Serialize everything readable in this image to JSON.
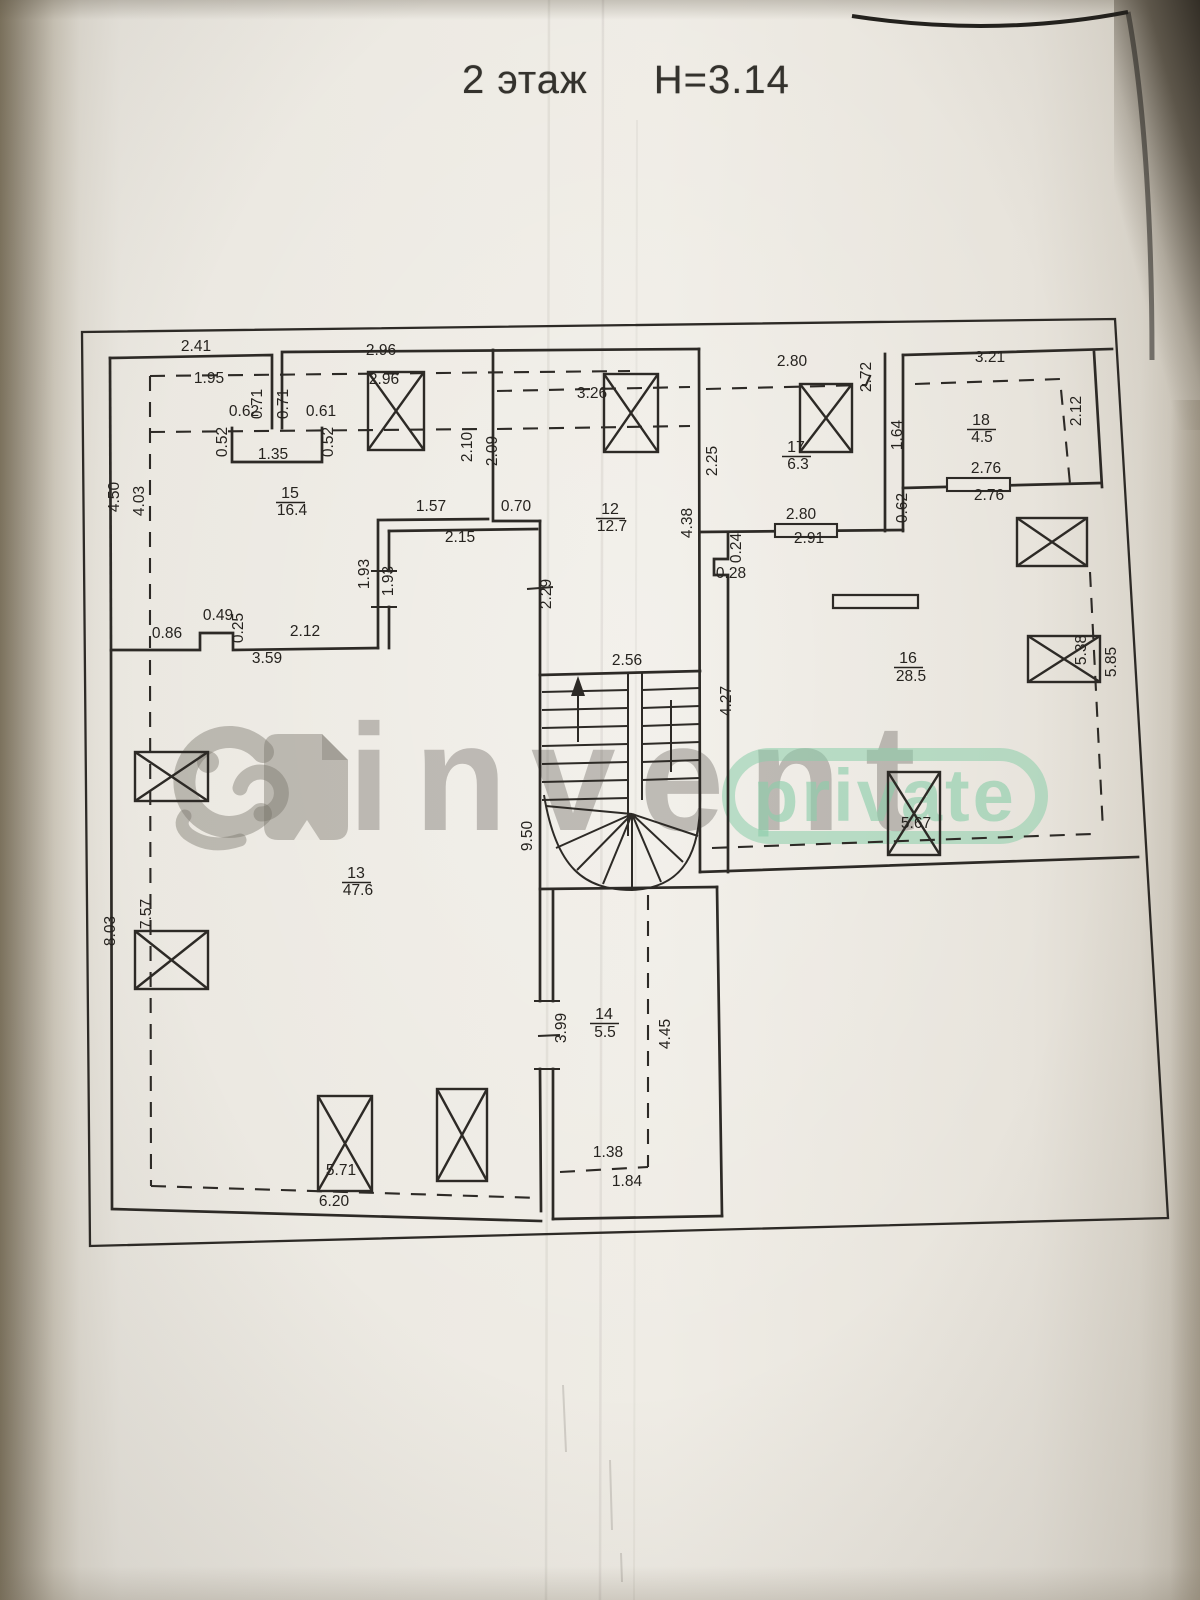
{
  "title": {
    "floor": "2 этаж",
    "height": "Н=3.14"
  },
  "watermark": {
    "brand": "invent",
    "badge": "private",
    "logo": "elephant-logo",
    "brand_color": "#69655e",
    "badge_color": "#8bcdaa"
  },
  "plan": {
    "rooms": [
      {
        "number": "12",
        "area_m2": "12.7"
      },
      {
        "number": "13",
        "area_m2": "47.6"
      },
      {
        "number": "14",
        "area_m2": "5.5"
      },
      {
        "number": "15",
        "area_m2": "16.4"
      },
      {
        "number": "16",
        "area_m2": "28.5"
      },
      {
        "number": "17",
        "area_m2": "6.3"
      },
      {
        "number": "18",
        "area_m2": "4.5"
      }
    ],
    "labels": [
      {
        "t": "2.41",
        "x": 196,
        "y": 351
      },
      {
        "t": "1.95",
        "x": 209,
        "y": 383
      },
      {
        "t": "0.71",
        "x": 262,
        "y": 404,
        "r": -90
      },
      {
        "t": "0.71",
        "x": 288,
        "y": 404,
        "r": -90
      },
      {
        "t": "0.62",
        "x": 244,
        "y": 416
      },
      {
        "t": "0.61",
        "x": 321,
        "y": 416
      },
      {
        "t": "0.52",
        "x": 227,
        "y": 442,
        "r": -90
      },
      {
        "t": "0.52",
        "x": 333,
        "y": 442,
        "r": -90
      },
      {
        "t": "1.35",
        "x": 273,
        "y": 459
      },
      {
        "t": "2.96",
        "x": 381,
        "y": 355
      },
      {
        "t": "2.96",
        "x": 384,
        "y": 384
      },
      {
        "t": "4.50",
        "x": 119,
        "y": 497,
        "r": -90
      },
      {
        "t": "4.03",
        "x": 144,
        "y": 501,
        "r": -90
      },
      {
        "t": "15",
        "x": 290,
        "y": 498,
        "k": "room",
        "u": 1
      },
      {
        "t": "16.4",
        "x": 292,
        "y": 515,
        "k": "area"
      },
      {
        "t": "1.57",
        "x": 431,
        "y": 511
      },
      {
        "t": "0.70",
        "x": 516,
        "y": 511
      },
      {
        "t": "2.15",
        "x": 460,
        "y": 542
      },
      {
        "t": "1.93",
        "x": 369,
        "y": 574,
        "r": -90
      },
      {
        "t": "1.93",
        "x": 393,
        "y": 581,
        "r": -90
      },
      {
        "t": "0.49",
        "x": 218,
        "y": 620
      },
      {
        "t": "0.25",
        "x": 243,
        "y": 628,
        "r": -90
      },
      {
        "t": "0.86",
        "x": 167,
        "y": 638
      },
      {
        "t": "2.12",
        "x": 305,
        "y": 636
      },
      {
        "t": "3.59",
        "x": 267,
        "y": 663
      },
      {
        "t": "3.26",
        "x": 592,
        "y": 398
      },
      {
        "t": "2.10",
        "x": 472,
        "y": 447,
        "r": -90
      },
      {
        "t": "2.09",
        "x": 497,
        "y": 451,
        "r": -90
      },
      {
        "t": "12",
        "x": 610,
        "y": 514,
        "k": "room",
        "u": 1
      },
      {
        "t": "12.7",
        "x": 612,
        "y": 531,
        "k": "area"
      },
      {
        "t": "2.29",
        "x": 551,
        "y": 594,
        "r": -90
      },
      {
        "t": "4.38",
        "x": 692,
        "y": 523,
        "r": -90
      },
      {
        "t": "2.56",
        "x": 627,
        "y": 665
      },
      {
        "t": "4.27",
        "x": 731,
        "y": 701,
        "r": -90
      },
      {
        "t": "9.50",
        "x": 532,
        "y": 836,
        "r": -90
      },
      {
        "t": "2.80",
        "x": 792,
        "y": 366
      },
      {
        "t": "2.72",
        "x": 871,
        "y": 377,
        "r": -90
      },
      {
        "t": "2.25",
        "x": 717,
        "y": 461,
        "r": -90
      },
      {
        "t": "17",
        "x": 796,
        "y": 452,
        "k": "room",
        "u": 1
      },
      {
        "t": "6.3",
        "x": 798,
        "y": 469,
        "k": "area"
      },
      {
        "t": "2.80",
        "x": 801,
        "y": 519
      },
      {
        "t": "2.91",
        "x": 809,
        "y": 543
      },
      {
        "t": "0.24",
        "x": 741,
        "y": 548,
        "r": -90
      },
      {
        "t": "0.28",
        "x": 731,
        "y": 578
      },
      {
        "t": "3.21",
        "x": 990,
        "y": 362
      },
      {
        "t": "2.12",
        "x": 1081,
        "y": 411,
        "r": -90
      },
      {
        "t": "1.64",
        "x": 902,
        "y": 435,
        "r": -90
      },
      {
        "t": "18",
        "x": 981,
        "y": 425,
        "k": "room",
        "u": 1
      },
      {
        "t": "4.5",
        "x": 982,
        "y": 442,
        "k": "area"
      },
      {
        "t": "2.76",
        "x": 986,
        "y": 473
      },
      {
        "t": "2.76",
        "x": 989,
        "y": 500
      },
      {
        "t": "0.62",
        "x": 907,
        "y": 508,
        "r": -90
      },
      {
        "t": "16",
        "x": 908,
        "y": 663,
        "k": "room",
        "u": 1
      },
      {
        "t": "28.5",
        "x": 911,
        "y": 681,
        "k": "area"
      },
      {
        "t": "5.38",
        "x": 1086,
        "y": 650,
        "r": -90
      },
      {
        "t": "5.85",
        "x": 1116,
        "y": 662,
        "r": -90
      },
      {
        "t": "5.67",
        "x": 916,
        "y": 828
      },
      {
        "t": "7.57",
        "x": 151,
        "y": 914,
        "r": -90
      },
      {
        "t": "8.03",
        "x": 115,
        "y": 931,
        "r": -90
      },
      {
        "t": "13",
        "x": 356,
        "y": 878,
        "k": "room",
        "u": 1
      },
      {
        "t": "47.6",
        "x": 358,
        "y": 895,
        "k": "area"
      },
      {
        "t": "5.71",
        "x": 341,
        "y": 1175
      },
      {
        "t": "6.20",
        "x": 334,
        "y": 1206
      },
      {
        "t": "3.99",
        "x": 566,
        "y": 1028,
        "r": -90
      },
      {
        "t": "14",
        "x": 604,
        "y": 1019,
        "k": "room",
        "u": 1
      },
      {
        "t": "5.5",
        "x": 605,
        "y": 1037,
        "k": "area"
      },
      {
        "t": "4.45",
        "x": 670,
        "y": 1034,
        "r": -90
      },
      {
        "t": "1.38",
        "x": 608,
        "y": 1157
      },
      {
        "t": "1.84",
        "x": 627,
        "y": 1186
      }
    ]
  }
}
